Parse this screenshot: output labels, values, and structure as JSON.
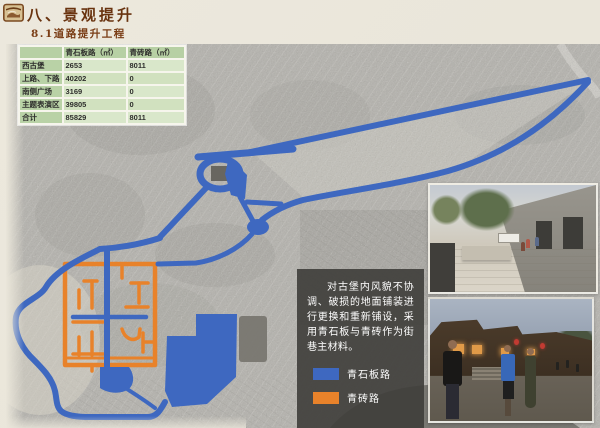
{
  "slide": {
    "title": "八、景观提升",
    "subtitle": "8.1道路提升工程",
    "header_icon": "pavilion-seal-icon"
  },
  "table": {
    "headers": [
      "",
      "青石板路（㎡）",
      "青砖路（㎡）"
    ],
    "rows": [
      {
        "label": "西古堡",
        "stone": "2653",
        "brick": "8011"
      },
      {
        "label": "上路、下路",
        "stone": "40202",
        "brick": "0"
      },
      {
        "label": "南侧广场",
        "stone": "3169",
        "brick": "0"
      },
      {
        "label": "主题表演区",
        "stone": "39805",
        "brick": "0"
      },
      {
        "label": "合计",
        "stone": "85829",
        "brick": "8011"
      }
    ]
  },
  "note": {
    "text": "对古堡内风貌不协调、破损的地面铺装进行更换和重新铺设，采用青石板与青砖作为街巷主材料。"
  },
  "legend": {
    "items": [
      {
        "label": "青石板路",
        "color": "#3e68c0"
      },
      {
        "label": "青砖路",
        "color": "#e8822a"
      }
    ]
  },
  "colors": {
    "stone_road_blue": "#3e68c0",
    "brick_road_orange": "#e8822a",
    "paper_background": "#eae6da",
    "title_brown": "#69330f",
    "table_header_green": "#b7d0a4",
    "table_cell_green": "#d9e7ca",
    "note_box_gray": "#3e3d3a"
  }
}
